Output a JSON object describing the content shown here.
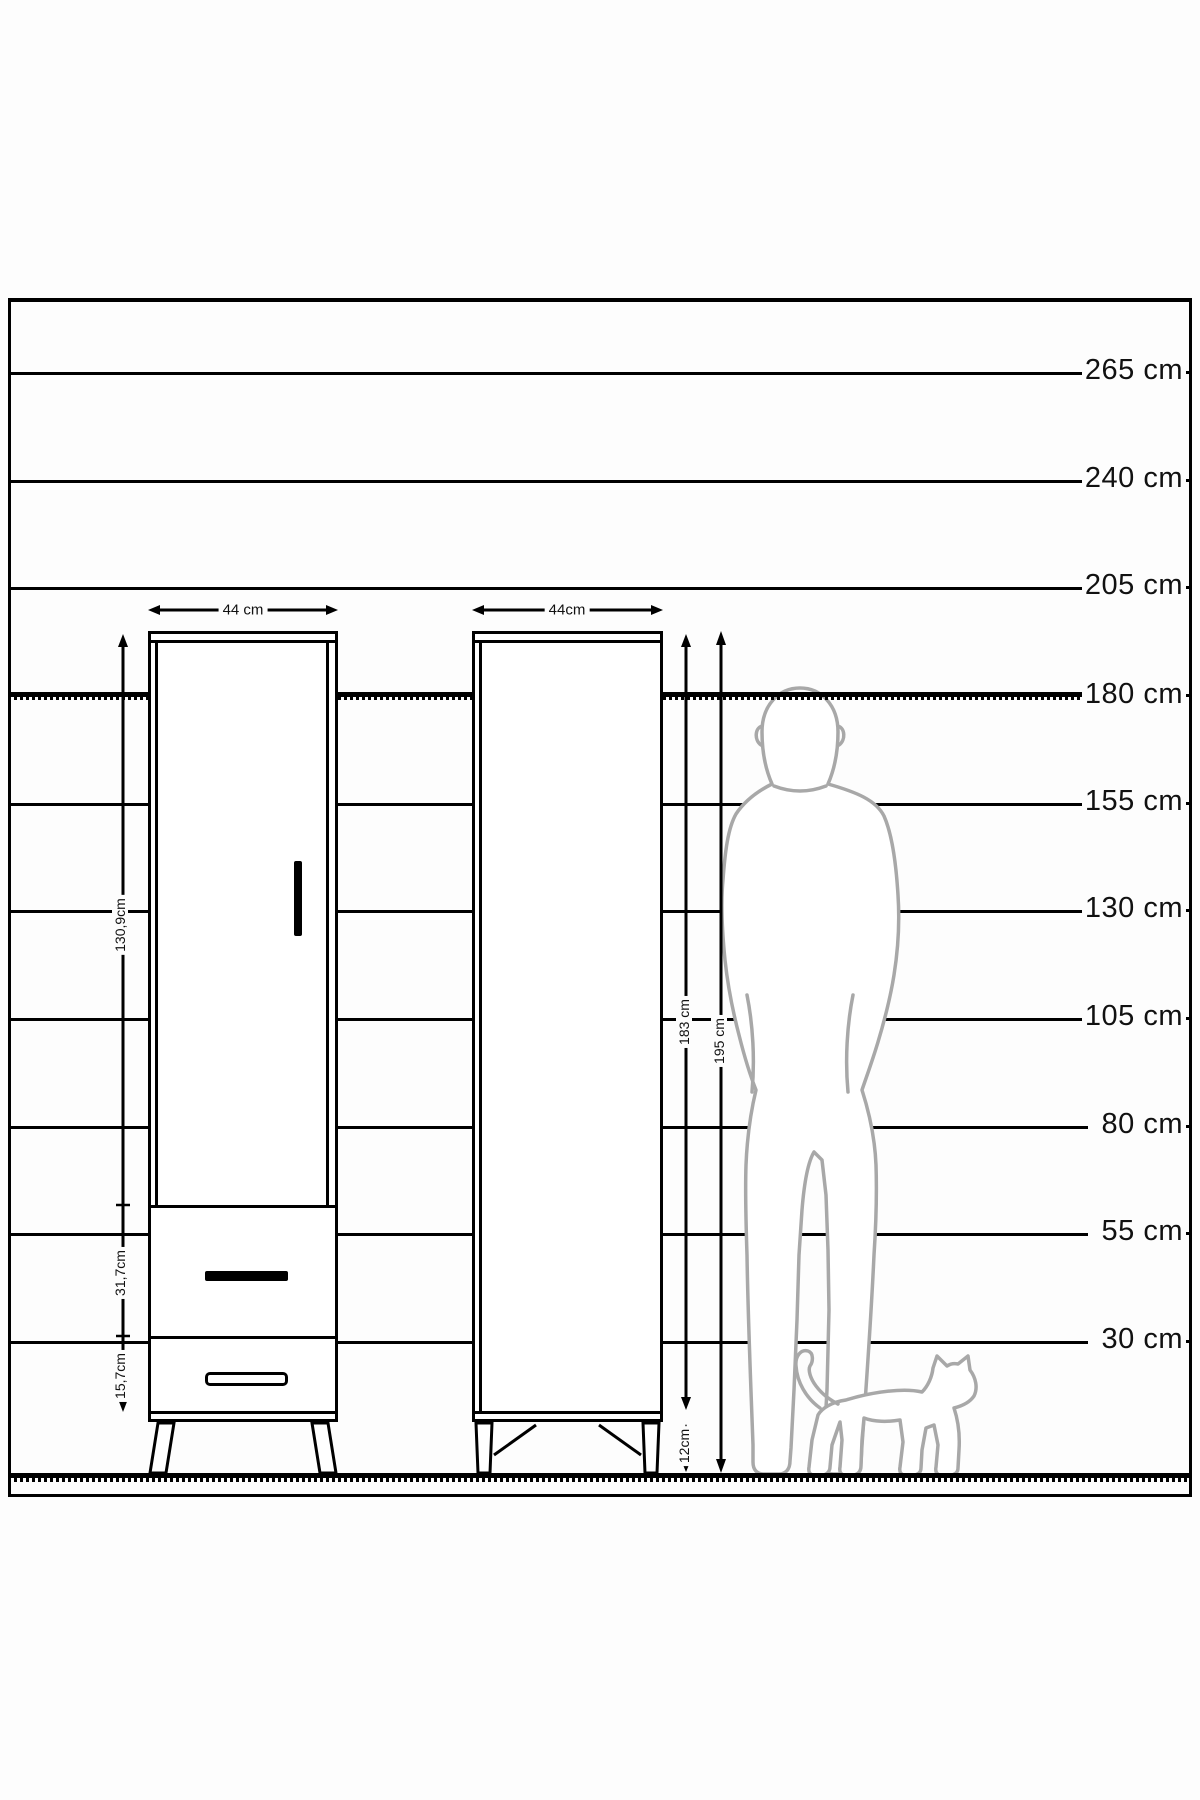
{
  "title": "wardrobe-dimension-diagram",
  "colors": {
    "line": "#000000",
    "silhouette": "#a8a8a8",
    "background": "#fdfdfd"
  },
  "scale": {
    "unit": "cm",
    "labels": [
      {
        "text": "265 cm",
        "value_cm": 265
      },
      {
        "text": "240 cm",
        "value_cm": 240
      },
      {
        "text": "205 cm",
        "value_cm": 205
      },
      {
        "text": "180 cm",
        "value_cm": 180
      },
      {
        "text": "155 cm",
        "value_cm": 155
      },
      {
        "text": "130 cm",
        "value_cm": 130
      },
      {
        "text": "105 cm",
        "value_cm": 105
      },
      {
        "text": "80 cm",
        "value_cm": 80
      },
      {
        "text": "55 cm",
        "value_cm": 55
      },
      {
        "text": "30 cm",
        "value_cm": 30
      }
    ]
  },
  "cabinet_front": {
    "width_label": "44 cm",
    "door_height_label": "130,9cm",
    "drawer_height_label": "31,7cm",
    "lower_drawer_height_label": "15,7cm"
  },
  "cabinet_side": {
    "width_label": "44cm",
    "body_height_label": "183 cm",
    "total_height_label": "195 cm",
    "leg_height_label": "12cm"
  },
  "figures": {
    "man": "man-silhouette",
    "cat": "cat-silhouette"
  }
}
